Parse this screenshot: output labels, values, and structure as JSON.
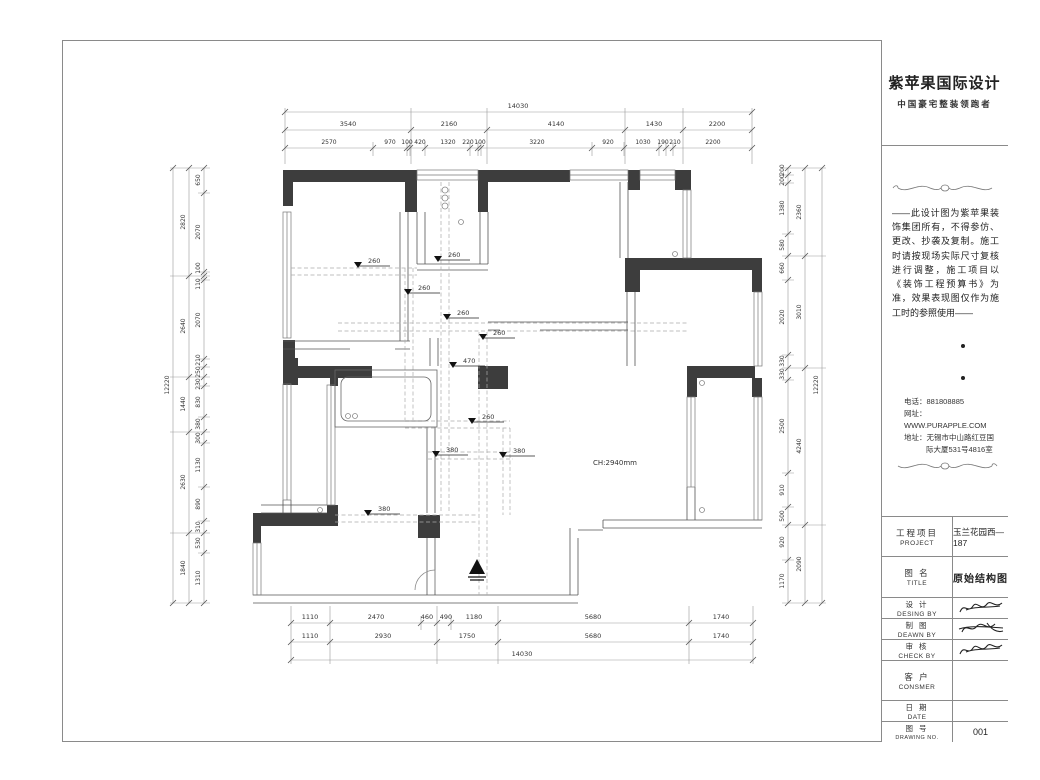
{
  "sheet": {
    "logo": {
      "name": "紫苹果国际设计",
      "tagline": "中国豪宅整装领跑者"
    },
    "disclaimer": "——此设计图为紫苹果装饰集团所有，不得参仿、更改、抄袭及复制。施工时请按现场实际尺寸复核进行调整，施工项目以《装饰工程预算书》为准，效果表现图仅作为施工时的参照使用——",
    "contact": {
      "lines": [
        "电话：881808885",
        "网址：WWW.PURAPPLE.COM",
        "地址：无锡市中山路红豆国",
        "际大厦531号4816室"
      ]
    },
    "table": {
      "project": {
        "cn": "工程项目",
        "en": "PROJECT",
        "value": "玉兰花园西—187"
      },
      "title": {
        "cn": "图  名",
        "en": "TITLE",
        "value": "原始结构图"
      },
      "design": {
        "cn": "设  计",
        "en": "DESING BY"
      },
      "draw": {
        "cn": "制  图",
        "en": "DEAWN BY"
      },
      "check": {
        "cn": "审  核",
        "en": "CHECK BY"
      },
      "consumer": {
        "cn": "客  户",
        "en": "CONSMER"
      },
      "date": {
        "cn": "日  期",
        "en": "DATE"
      },
      "number": {
        "cn": "图  号",
        "en": "DRAWING NO.",
        "value": "001"
      }
    }
  },
  "plan": {
    "note": "CH:2940mm",
    "beams": [
      "260",
      "260",
      "260",
      "260",
      "260",
      "260",
      "470",
      "380",
      "380",
      "380"
    ],
    "dims": {
      "top_overall": "14030",
      "top_row2": [
        "3540",
        "2160",
        "4140",
        "1430",
        "2200"
      ],
      "top_row3": [
        "2570",
        "970",
        "100",
        "420",
        "1320",
        "220",
        "100",
        "3220",
        "920",
        "1030",
        "190",
        "210",
        "2200"
      ],
      "bottom_row1": [
        "1110",
        "2470",
        "460",
        "490",
        "1180",
        "5680",
        "1740"
      ],
      "bottom_row2": [
        "1110",
        "2930",
        "1750",
        "5680",
        "1740"
      ],
      "bottom_overall": "14030",
      "left_overall": "12220",
      "left_mid": [
        "2820",
        "2640",
        "1440",
        "2630",
        "1840"
      ],
      "left_inner": [
        "650",
        "2070",
        "100",
        "110",
        "2070",
        "210",
        "250",
        "230",
        "830",
        "380",
        "300",
        "1130",
        "890",
        "310",
        "530",
        "1310"
      ],
      "right_overall": "12220",
      "right_mid": [
        "2360",
        "3010",
        "4240",
        "2090"
      ],
      "right_inner": [
        "200",
        "200",
        "1380",
        "580",
        "660",
        "2020",
        "330",
        "330",
        "2500",
        "910",
        "500",
        "920",
        "1170"
      ]
    }
  }
}
